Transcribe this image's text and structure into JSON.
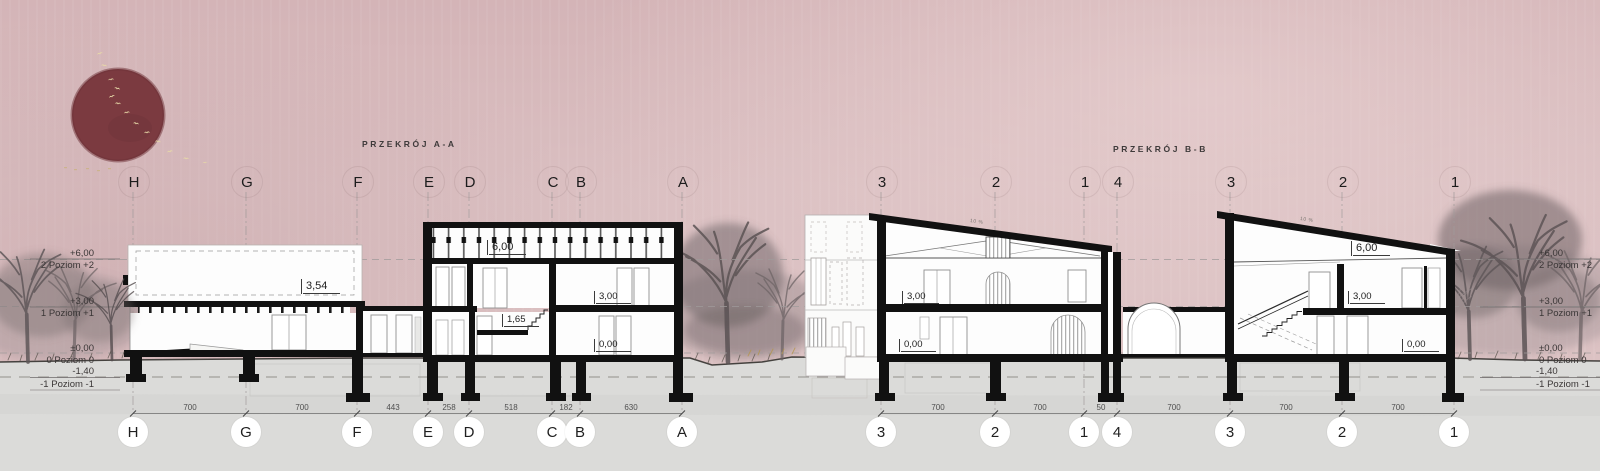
{
  "sections": {
    "a": {
      "title": "PRZEKRÓJ A-A",
      "grid": [
        "H",
        "G",
        "F",
        "E",
        "D",
        "C",
        "B",
        "A"
      ],
      "dims": [
        "700",
        "700",
        "443",
        "258",
        "518",
        "182",
        "630"
      ]
    },
    "b": {
      "title": "PRZEKRÓJ B-B",
      "grid": [
        "3",
        "2",
        "1",
        "4",
        "3",
        "2",
        "1"
      ],
      "dims": [
        "700",
        "700",
        "50",
        "700",
        "700",
        "700"
      ]
    }
  },
  "levels": [
    {
      "value": "+6,00",
      "name": "2 Poziom +2"
    },
    {
      "value": "+3,00",
      "name": "1 Poziom +1"
    },
    {
      "value": "±0,00",
      "name": "0 Poziom 0"
    },
    {
      "value": "-1,40",
      "name": "-1 Poziom -1"
    }
  ],
  "marks": {
    "a_attic": "3,54",
    "a_roof": "6,00",
    "a_floor1": "3,00",
    "a_mezz": "1,65",
    "a_ground": "0,00",
    "b1_floor1": "3,00",
    "b1_ground": "0,00",
    "b1_slope": "10 %",
    "b2_roof": "6,00",
    "b2_floor1": "3,00",
    "b2_ground": "0,00",
    "b2_slope": "10 %"
  },
  "colors": {
    "sky": "#d9bcbe",
    "ground": "#dbdbd9",
    "sun": "#7b3a40",
    "ink": "#141414",
    "birds": "#e7d9a8"
  }
}
